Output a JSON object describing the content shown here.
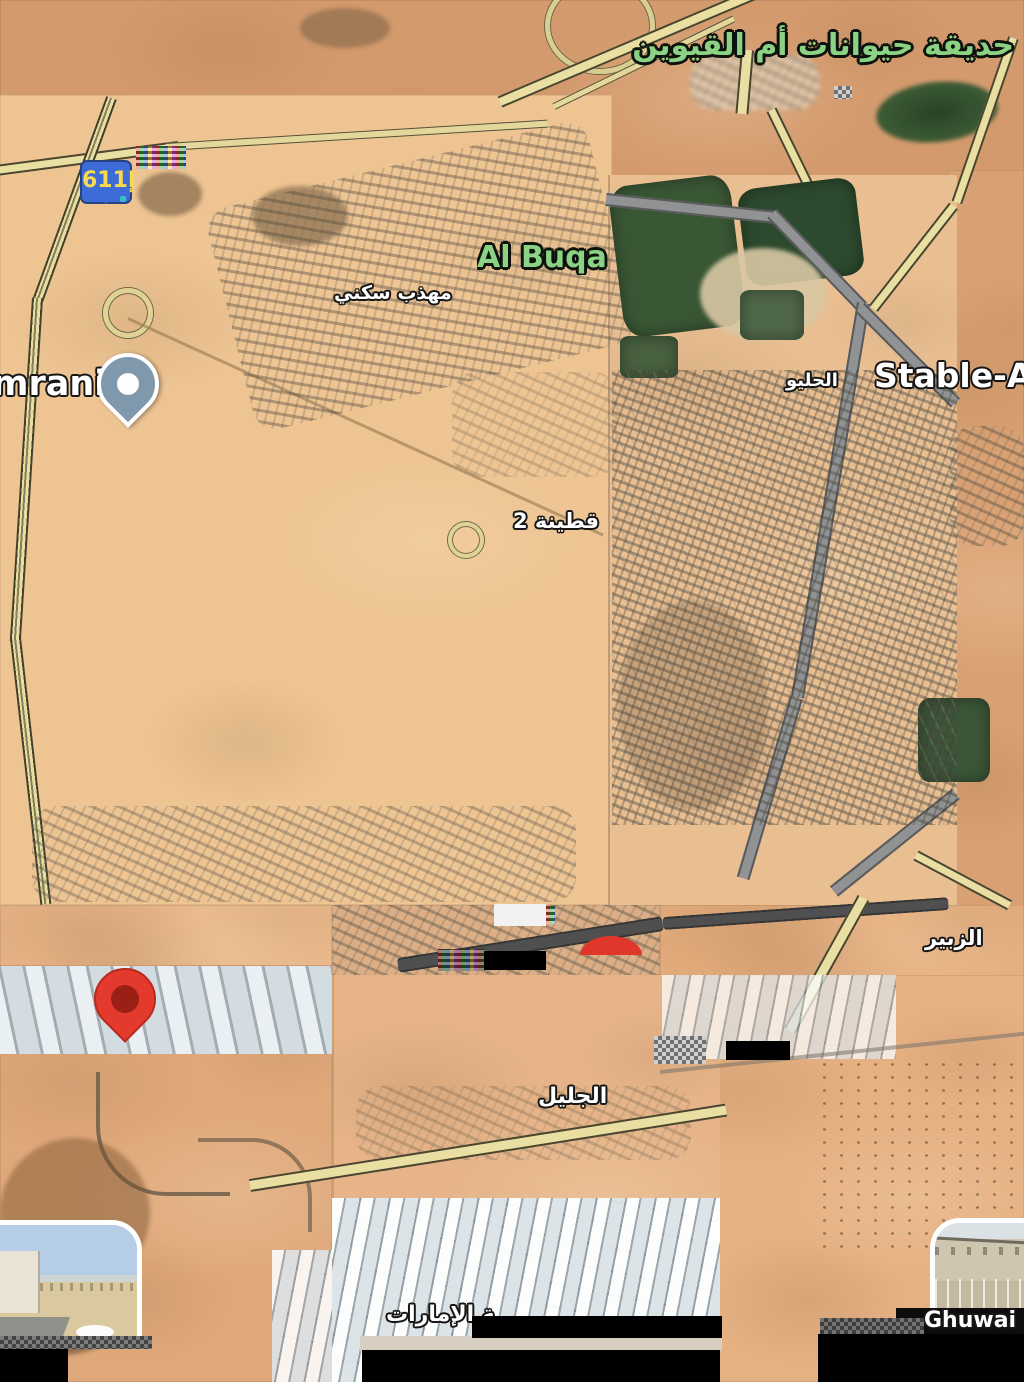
{
  "labels": {
    "zoo": "حديقة حيوانات أم القيوين",
    "al_buqa": "Al Buqa",
    "residential": "مهذب سكني",
    "mrani": "mrani",
    "stable": "Stable-Ar",
    "al_haliyo": "الحليو",
    "qutainah": "قطينة 2",
    "al_zubair": "الزبير",
    "al_jalil": "الجليل",
    "emirates": "ـة الإمارات",
    "ghuwai": "Ghuwai"
  },
  "route_shield": {
    "label": "611إ"
  },
  "icons": {
    "marker_gray_blue": "map-pin with white core",
    "marker_red": "map-pin with dark red core",
    "marker_red_clipped": "clipped red pin head (half disc)",
    "roundabout": "pale ring road circle",
    "streetview_thumb_left": "photo preview, rounded top-right corner",
    "streetview_thumb_right": "photo preview, rounded top-left corner"
  },
  "colors": {
    "label_green": "#8bd284",
    "label_white": "#ffffff",
    "label_outline": "#161616",
    "shield_blue": "#3d6cd8",
    "shield_text": "#f8da4e",
    "pin_red": "#e33a2d",
    "pin_red_core": "#9a2015",
    "pin_gray_blue": "#7f98ac",
    "road_yellow": "#eadfa3",
    "road_casing": "#4a452f",
    "road_gray": "#919293",
    "farm_green": "#3a5735",
    "redaction": "#000000"
  }
}
